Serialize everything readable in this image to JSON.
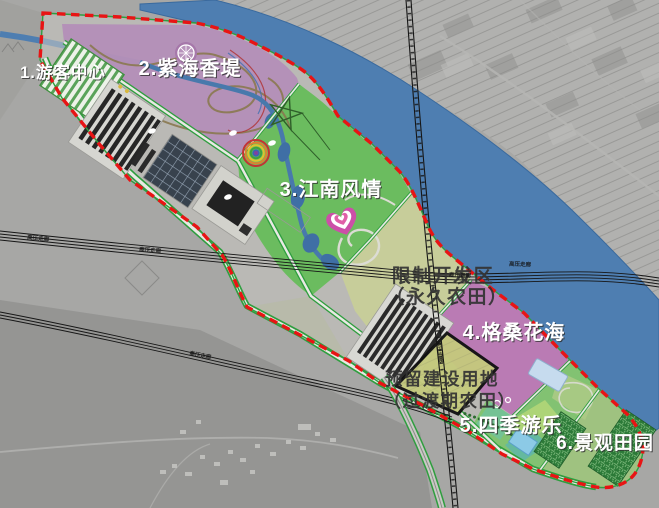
{
  "map": {
    "zone_labels": [
      {
        "label": "1.游客中心"
      },
      {
        "label": "2.紫海香堤"
      },
      {
        "label": "3.江南风情"
      },
      {
        "label": "4.格桑花海"
      },
      {
        "label": "5.四季游乐"
      },
      {
        "label": "6.景观田园"
      }
    ],
    "annotations": {
      "restricted_line1": "限制开发区",
      "restricted_line2": "（永久农田）",
      "reserved_line1": "预留建设用地",
      "reserved_line2": "（过渡期农田）",
      "hv_corridor": "高压走廊"
    },
    "colors": {
      "boundary_red": "#e81414",
      "river_blue": "#4e7eb1",
      "zone_purple": "#b48db8",
      "zone_green": "#63bd55",
      "zone_pale_farmland": "#c9cf97",
      "zone_magenta": "#ba74b4",
      "zone_reserved": "#c5ca7d",
      "road_green": "#2f9e3f",
      "satellite_gray": "#a7a7a5"
    }
  }
}
